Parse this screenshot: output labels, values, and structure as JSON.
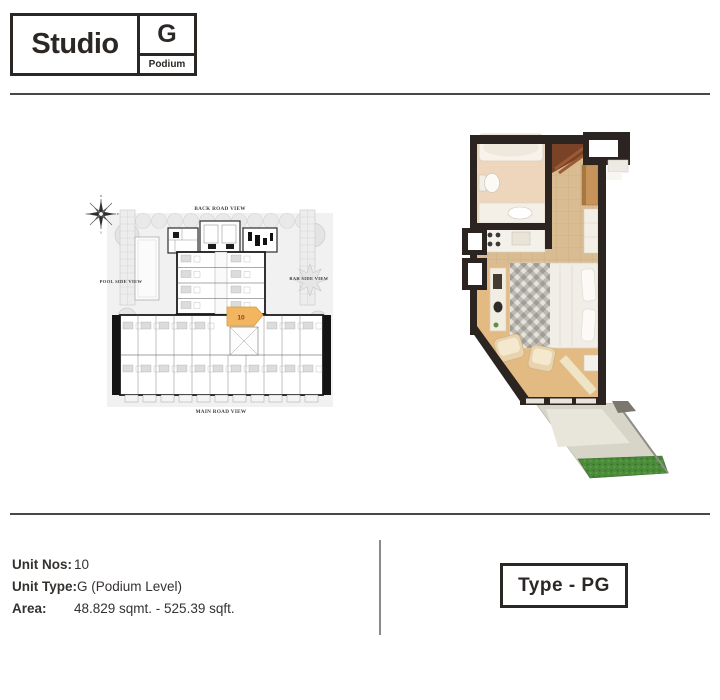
{
  "header": {
    "title": "Studio",
    "unit_letter": "G",
    "level_label": "Podium"
  },
  "compass": {
    "north": "N",
    "east": "E",
    "south": "S",
    "west": "W"
  },
  "site_plan": {
    "view_labels": {
      "back": "BACK ROAD VIEW",
      "pool": "POOL SIDE VIEW",
      "bar": "BAR SIDE VIEW",
      "main": "MAIN ROAD VIEW"
    },
    "highlighted_unit_no": "10",
    "highlight_color": "#F3B660"
  },
  "unit_details": {
    "rows": [
      {
        "label": "Unit Nos:",
        "value": "10"
      },
      {
        "label": "Unit Type:",
        "value": "G (Podium Level)"
      },
      {
        "label": "Area:",
        "value": "48.829 sqmt. - 525.39 sqft."
      }
    ]
  },
  "type_badge": {
    "label": "Type - PG"
  },
  "colors": {
    "ink": "#2B2725",
    "rule": "#4A4644",
    "divider": "#8A8A8A",
    "highlight": "#F3B660",
    "wall": "#2B2420",
    "floor_tan": "#E4BA83",
    "grass": "#4A8C39"
  }
}
